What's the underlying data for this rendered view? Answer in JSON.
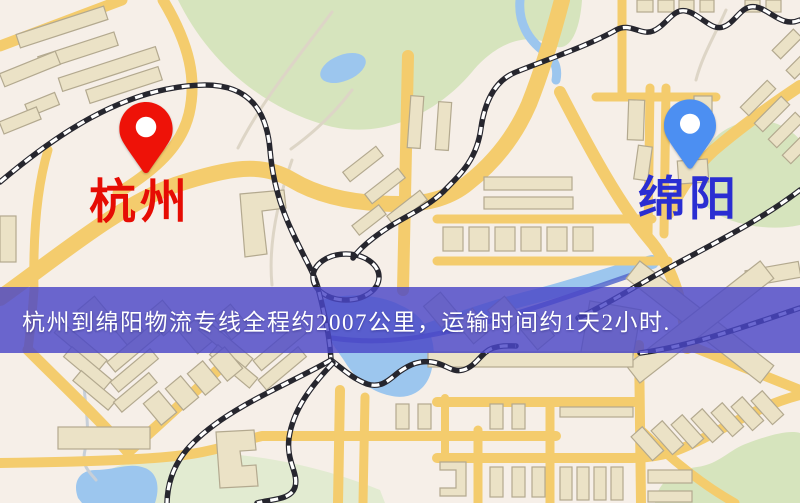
{
  "banner": {
    "text": "杭州到绵阳物流专线全程约2007公里，运输时间约1天2小时."
  },
  "markers": {
    "origin": {
      "label": "杭州",
      "pin": "red-map-pin"
    },
    "destination": {
      "label": "绵阳",
      "pin": "blue-map-pin"
    }
  },
  "colors": {
    "map_bg": "#f6efe8",
    "banner_bg": "rgba(74,71,199,0.82)",
    "banner_text": "#ffffff",
    "origin_text": "#e60c04",
    "destination_text": "#2a2ed2",
    "origin_pin": "#ee1208",
    "destination_pin": "#4c8ff2",
    "road": "#f4cc6d",
    "building": "#ebe2c6",
    "building_outline": "#b3a98f",
    "park": "#d6e4bd",
    "park_pale": "#e2ebd1",
    "water": "#9cc6ee",
    "water_deep": "#5568cc",
    "railway_dark": "#26262e",
    "railway_light": "#ffffff",
    "path": "#ddd5c6"
  }
}
